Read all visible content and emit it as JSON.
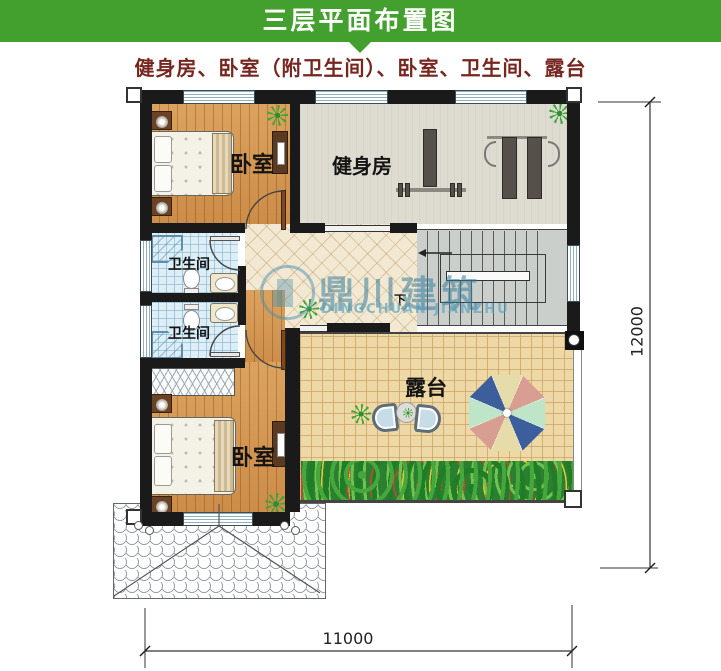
{
  "header": {
    "title": "三层平面布置图"
  },
  "subtitle": "健身房、卧室（附卫生间）、卧室、卫生间、露台",
  "plan": {
    "rooms": {
      "bedroom_top": {
        "label": "卧室"
      },
      "gym": {
        "label": "健身房"
      },
      "bathroom_top": {
        "label": "卫生间"
      },
      "bathroom_bottom": {
        "label": "卫生间"
      },
      "bedroom_bottom": {
        "label": "卧室"
      },
      "terrace": {
        "label": "露台"
      },
      "stairs": {
        "direction_label": "下"
      }
    },
    "dimensions": {
      "right_total": "12000",
      "bottom_total": "11000"
    },
    "watermark": {
      "brand": "鼎川建筑",
      "brand_latin": "DINGCHUAN JIANZHU"
    }
  },
  "colors": {
    "banner_green": "#43a02e",
    "subtitle_text": "#76251f",
    "wall": "#1a1a1a",
    "wood_floor": "#d3954e",
    "gym_floor": "#dedcd0",
    "bath_floor": "#ddeef6",
    "hall_tile": "#f3e9d3",
    "terrace_tile": "#eed9a6",
    "stairs_floor": "#cbcfcb",
    "watermark_teal": "#4a93ad",
    "umbrella_segments": [
      "#e5dca9",
      "#d99e92",
      "#bfe5c9",
      "#3d5e9c"
    ]
  }
}
